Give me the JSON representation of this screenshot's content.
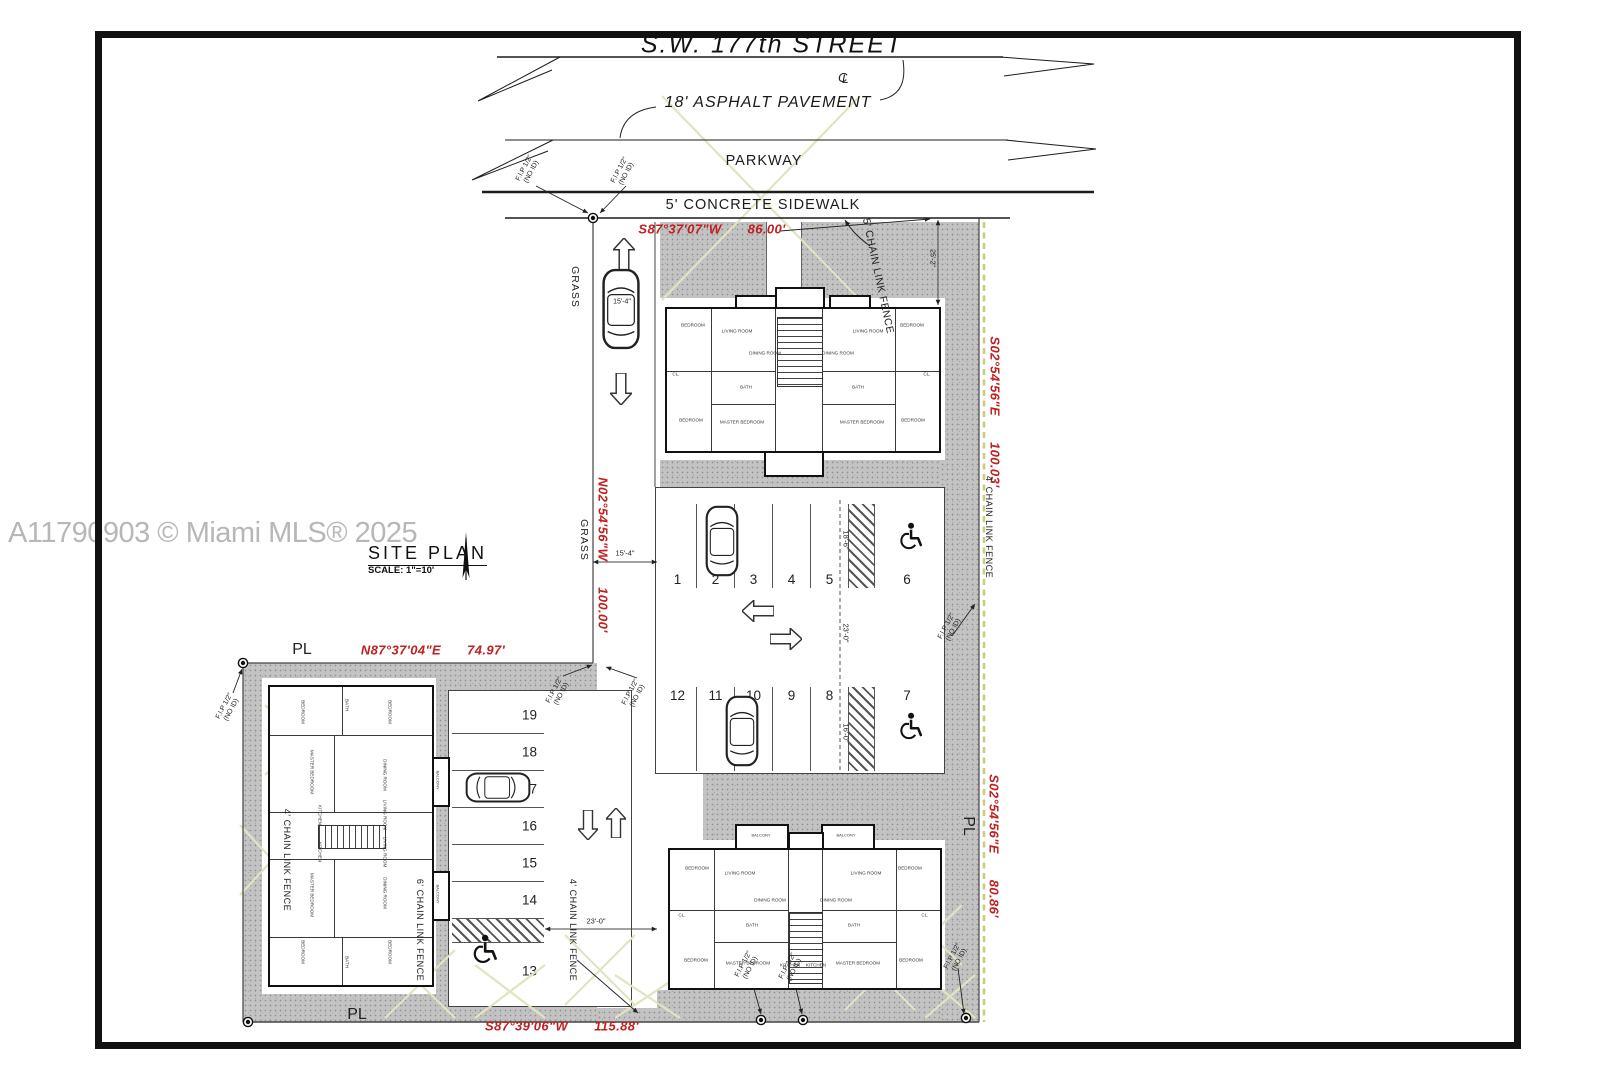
{
  "watermark": "A11790903 © Miami MLS® 2025",
  "street": {
    "name": "S.W. 177th STREET",
    "cl_parts": [
      "C",
      "L"
    ],
    "pavement": "18' ASPHALT PAVEMENT",
    "parkway": "PARKWAY",
    "sidewalk": "5' CONCRETE SIDEWALK"
  },
  "title_block": {
    "title": "SITE PLAN",
    "scale": "SCALE: 1\"=10'"
  },
  "bearings": {
    "north": "S87°37'07\"W",
    "north_len": "86.00'",
    "east_upper": "S02°54'56\"E",
    "east_upper_len": "100.03'",
    "west": "N02°54'56\"W",
    "west_len": "100.00'",
    "mid": "N87°37'04\"E",
    "mid_len": "74.97'",
    "east_lower": "S02°54'56\"E",
    "east_lower_len": "80.86'",
    "south": "S87°39'06\"W",
    "south_len": "115.88'"
  },
  "labels": {
    "pl": "PL",
    "grass": "GRASS",
    "fip_line1": "F.I.P 1/2\"",
    "fip_line2": "(NO ID)",
    "fence_5": "5' CHAIN LINK FENCE",
    "fence_4": "4' CHAIN LINK FENCE",
    "fence_6": "6' CHAIN LINK FENCE",
    "dim_15_4": "15'-4\"",
    "dim_18_6": "18'-6\"",
    "dim_23_0": "23'-0\"",
    "dim_16_0": "16'-0\"",
    "dim_25_2": "25'-2\""
  },
  "parking": {
    "top_row": [
      "1",
      "2",
      "3",
      "4",
      "5",
      "6"
    ],
    "bottom_row": [
      "12",
      "11",
      "10",
      "9",
      "8",
      "7"
    ],
    "left_col": [
      "19",
      "18",
      "17",
      "16",
      "15",
      "14",
      "13"
    ]
  },
  "rooms": {
    "bedroom": "BEDROOM",
    "master": "MASTER BEDROOM",
    "living": "LIVING ROOM",
    "dining": "DINING ROOM",
    "bath": "BATH",
    "kitchen": "KITCHEN",
    "closet": "CL.",
    "balcony": "BALCONY"
  },
  "colors": {
    "bearing_red": "#c02020",
    "paving_gray": "#c3c3c3",
    "fence_yellow": "#c9cd7d",
    "grass_hatch": "#e2e6c4",
    "line": "#1c1c1c"
  }
}
